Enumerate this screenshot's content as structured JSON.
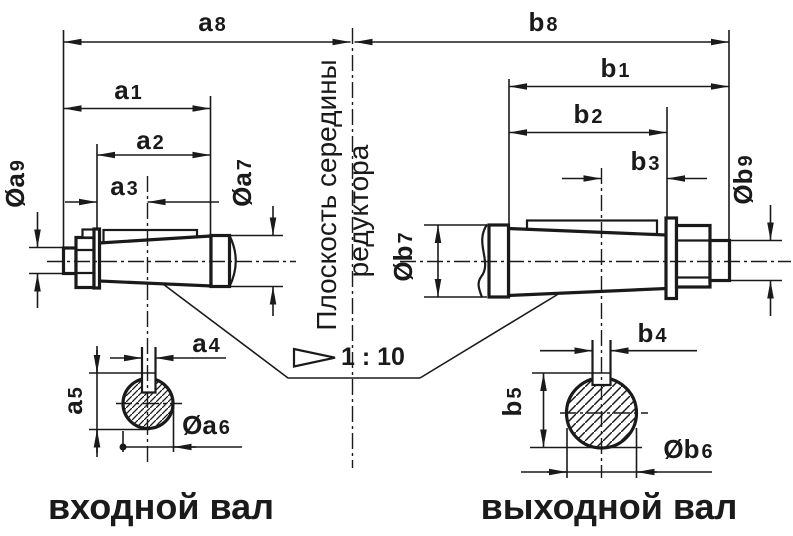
{
  "colors": {
    "ink": "#1a1a1a",
    "background": "#ffffff"
  },
  "center_plane": {
    "line1": "Плоскость середины",
    "line2": "редуктора"
  },
  "taper": {
    "label": "1 : 10"
  },
  "captions": {
    "input_shaft": "входной вал",
    "output_shaft": "выходной вал"
  },
  "dims": {
    "a1": {
      "p": "a",
      "d": "1"
    },
    "a2": {
      "p": "a",
      "d": "2"
    },
    "a3": {
      "p": "a",
      "d": "3"
    },
    "a4": {
      "p": "a",
      "d": "4"
    },
    "a5": {
      "p": "a",
      "d": "5"
    },
    "a6": {
      "p": "Øa",
      "d": "6"
    },
    "a7": {
      "p": "Øa",
      "d": "7"
    },
    "a8": {
      "p": "a",
      "d": "8"
    },
    "a9": {
      "p": "Øa",
      "d": "9"
    },
    "b1": {
      "p": "b",
      "d": "1"
    },
    "b2": {
      "p": "b",
      "d": "2"
    },
    "b3": {
      "p": "b",
      "d": "3"
    },
    "b4": {
      "p": "b",
      "d": "4"
    },
    "b5": {
      "p": "b",
      "d": "5"
    },
    "b6": {
      "p": "Øb",
      "d": "6"
    },
    "b7": {
      "p": "Øb",
      "d": "7"
    },
    "b8": {
      "p": "b",
      "d": "8"
    },
    "b9": {
      "p": "Øb",
      "d": "9"
    }
  }
}
